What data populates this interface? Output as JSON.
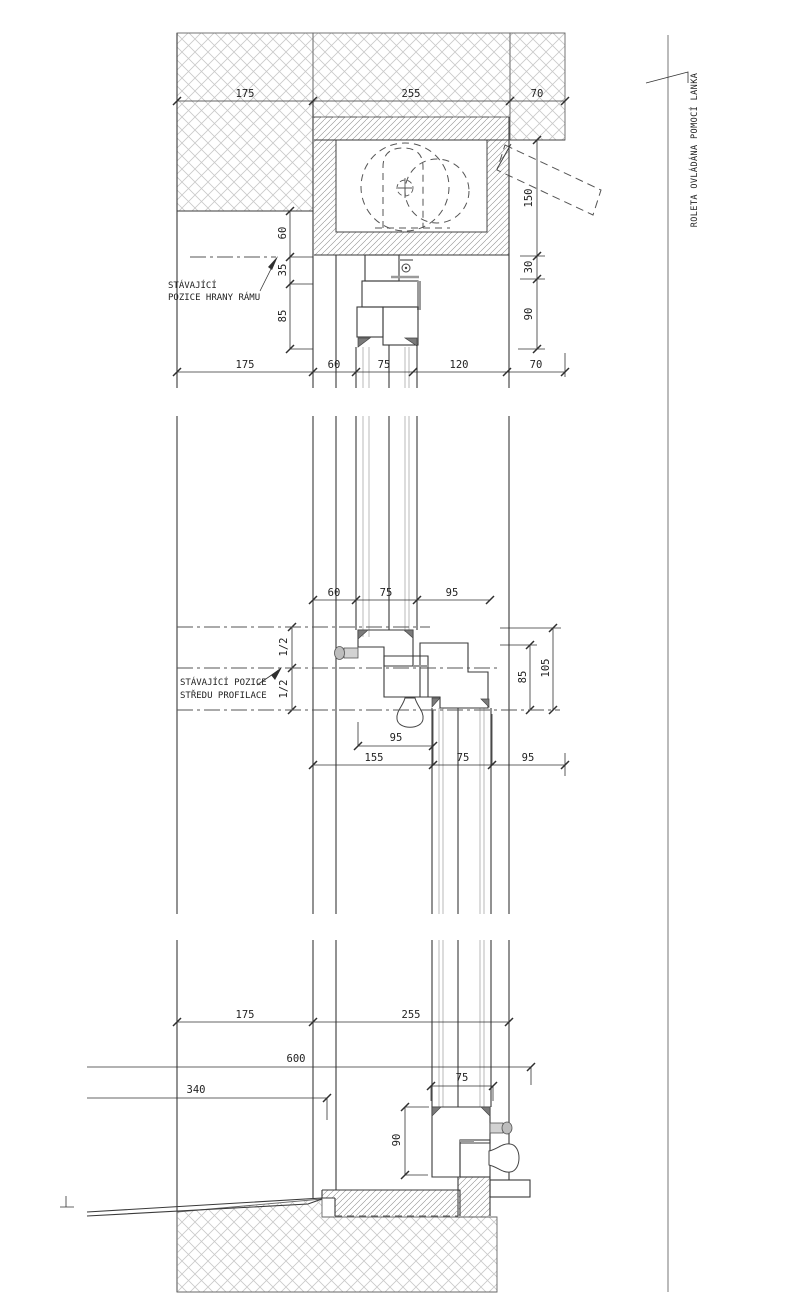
{
  "notes": {
    "head_line1": "STÁVAJÍCÍ",
    "head_line2": "POZICE HRANY RÁMU",
    "transom_line1": "STÁVAJÍCÍ POZICE",
    "transom_line2": "STŘEDU PROFILACE",
    "roleta": "ROLETA OVLÁDÁNA POMOCÍ LANKA"
  },
  "head": {
    "dims_top": [
      "175",
      "255",
      "70"
    ],
    "dims_bottom": [
      "175",
      "60",
      "75",
      "120",
      "70"
    ],
    "dims_left": [
      "60",
      "35",
      "85"
    ],
    "dims_right": [
      "150",
      "30",
      "90"
    ]
  },
  "transom": {
    "dims_top": [
      "60",
      "75",
      "95"
    ],
    "dims_half": [
      "1/2",
      "1/2"
    ],
    "dims_right": [
      "85",
      "105"
    ],
    "dim_inner": "95",
    "dims_bottom": [
      "155",
      "75",
      "95"
    ]
  },
  "sill": {
    "dims_top": [
      "175",
      "255"
    ],
    "dim_total": "600",
    "dim_offset": "340",
    "dim_sash": "75",
    "dim_height": "90"
  },
  "colors": {
    "line": "#3a3a3a",
    "dimension": "#2f2f2f",
    "profile_hatch": "#8f8f8f",
    "masonry_hatch": "#c9c9c9",
    "accent_gray": "#9a9a9a",
    "background": "#ffffff"
  }
}
